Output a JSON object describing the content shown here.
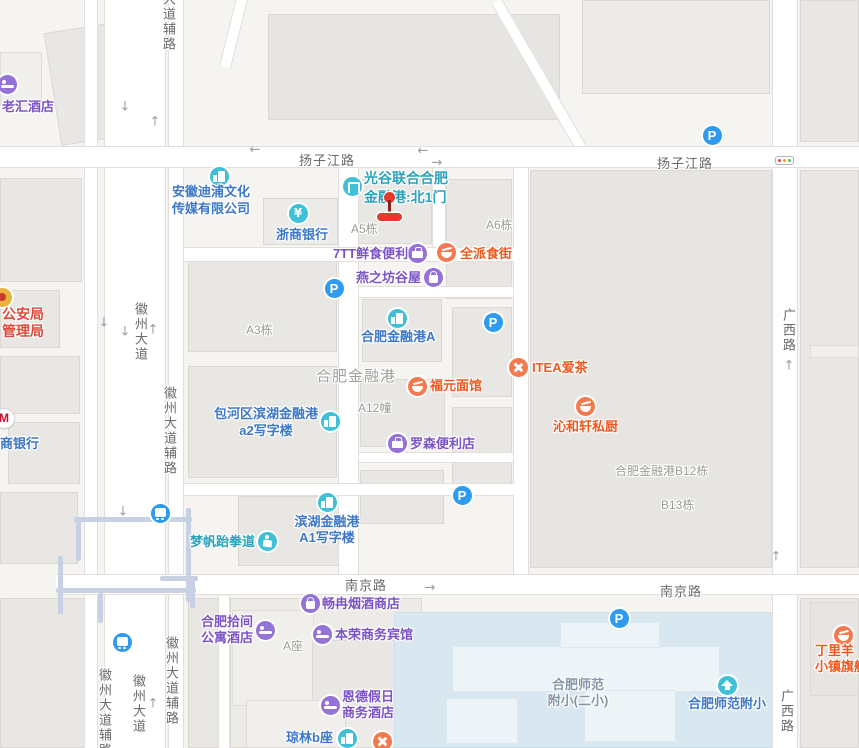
{
  "colors": {
    "purple_icon": "#9472d6",
    "purple_text": "#7b52c8",
    "teal_icon": "#3fc0d6",
    "blue_text": "#3d77c9",
    "teal_text": "#2aa3ba",
    "orange_icon": "#f5794e",
    "orange_text": "#f2571d",
    "parking_icon": "#2e9af0",
    "bus_icon": "#2e9af0",
    "building_text": "#9d9a96",
    "area_text": "#a3a09c",
    "gov_text": "#de4a3d",
    "school_text": "#8596a7",
    "road_text": "#6a6a6a",
    "marker_red": "#e23b2c"
  },
  "road_labels": [
    {
      "text": "扬子江路",
      "x": 299,
      "y": 150,
      "vertical": false
    },
    {
      "text": "扬子江路",
      "x": 657,
      "y": 153,
      "vertical": false
    },
    {
      "text": "南京路",
      "x": 345,
      "y": 575,
      "vertical": false
    },
    {
      "text": "南京路",
      "x": 660,
      "y": 581,
      "vertical": false
    },
    {
      "text": "广西路",
      "x": 779,
      "y": 308,
      "vertical": true
    },
    {
      "text": "广西路",
      "x": 777,
      "y": 689,
      "vertical": true
    },
    {
      "text": "大道辅路",
      "x": 159,
      "y": -8,
      "vertical": true
    },
    {
      "text": "徽州大道",
      "x": 131,
      "y": 302,
      "vertical": true
    },
    {
      "text": "徽州大道辅路",
      "x": 160,
      "y": 386,
      "vertical": true
    },
    {
      "text": "徽州大道辅路",
      "x": 95,
      "y": 668,
      "vertical": true
    },
    {
      "text": "徽州大道",
      "x": 129,
      "y": 674,
      "vertical": true
    },
    {
      "text": "徽州大道辅路",
      "x": 162,
      "y": 636,
      "vertical": true
    }
  ],
  "building_labels": [
    {
      "text": "A5栋",
      "x": 351,
      "y": 220
    },
    {
      "text": "A6栋",
      "x": 486,
      "y": 216
    },
    {
      "text": "A3栋",
      "x": 246,
      "y": 321
    },
    {
      "text": "A12幢",
      "x": 358,
      "y": 399
    },
    {
      "text": "合肥金融港B12栋",
      "x": 615,
      "y": 462
    },
    {
      "text": "B13栋",
      "x": 661,
      "y": 496
    },
    {
      "text": "A座",
      "x": 283,
      "y": 637
    }
  ],
  "area_labels": [
    {
      "text": "合肥金融港",
      "x": 316,
      "y": 365
    }
  ],
  "school_labels": [
    {
      "lines": [
        "合肥师范",
        "附小(二小)"
      ],
      "cx": 578,
      "y": 677
    }
  ],
  "pois": [
    {
      "id": "laohui-hotel",
      "icon": {
        "type": "bed",
        "name": "hotel-icon",
        "color": "purple_icon",
        "x": 7,
        "y": 84
      },
      "label": {
        "lines": [
          "老汇酒店"
        ],
        "color": "purple_text",
        "x": 2,
        "y": 99
      }
    },
    {
      "id": "police-bureau",
      "icon": {
        "type": "emblem",
        "name": "police-emblem-icon",
        "color": "",
        "x": 2,
        "y": 297
      },
      "label": {
        "lines": [
          "公安局",
          "管理局"
        ],
        "color": "gov_text",
        "x": 2,
        "y": 306,
        "size": 14,
        "lh": 17
      }
    },
    {
      "id": "cmb-bank",
      "icon": {
        "type": "M",
        "name": "cmb-logo-icon",
        "color": "",
        "x": 4,
        "y": 418
      },
      "label": {
        "lines": [
          "商银行"
        ],
        "color": "blue_text",
        "x": 0,
        "y": 436
      }
    },
    {
      "id": "anhui-dipu-company",
      "icon": {
        "type": "bldg",
        "name": "company-icon",
        "color": "teal_icon",
        "x": 219,
        "y": 176
      },
      "label": {
        "lines": [
          "安徽迪浦文化",
          "传媒有限公司"
        ],
        "color": "blue_text",
        "x": 172,
        "y": 183,
        "lh": 17
      }
    },
    {
      "id": "zheshang-bank",
      "icon": {
        "type": "yen",
        "name": "bank-yen-icon",
        "color": "teal_icon",
        "x": 298,
        "y": 213
      },
      "label": {
        "lines": [
          "浙商银行"
        ],
        "color": "blue_text",
        "x": 276,
        "y": 227
      }
    },
    {
      "id": "financial-port-north-gate",
      "icon": {
        "type": "gate",
        "name": "gate-icon",
        "color": "teal_icon",
        "x": 352,
        "y": 186
      },
      "label": {
        "lines": [
          "光谷联合合肥",
          "金融港:北1门"
        ],
        "color": "teal_text",
        "x": 364,
        "y": 169,
        "size": 14,
        "lh": 19
      }
    },
    {
      "id": "7tt-convenience",
      "icon": {
        "type": "shop",
        "name": "shop-icon",
        "color": "purple_icon",
        "x": 417,
        "y": 253
      },
      "label": {
        "lines": [
          "7TT鲜食便利"
        ],
        "color": "purple_text",
        "x": 333,
        "y": 246
      }
    },
    {
      "id": "quanpai-food-street",
      "icon": {
        "type": "bowl",
        "name": "restaurant-icon",
        "color": "orange_icon",
        "x": 446,
        "y": 252
      },
      "label": {
        "lines": [
          "全派食街"
        ],
        "color": "orange_text",
        "x": 460,
        "y": 246
      }
    },
    {
      "id": "yanzhifang-guwu",
      "icon": {
        "type": "bag",
        "name": "shopping-bag-icon",
        "color": "purple_icon",
        "x": 433,
        "y": 277
      },
      "label": {
        "lines": [
          "燕之坊谷屋"
        ],
        "color": "purple_text",
        "x": 356,
        "y": 270
      }
    },
    {
      "id": "parking-1",
      "icon": {
        "type": "P",
        "name": "parking-icon",
        "color": "parking_icon",
        "x": 334,
        "y": 288
      }
    },
    {
      "id": "financial-port-a",
      "icon": {
        "type": "bldg",
        "name": "building-icon",
        "color": "teal_icon",
        "x": 397,
        "y": 318
      },
      "label": {
        "lines": [
          "合肥金融港A"
        ],
        "color": "blue_text",
        "x": 361,
        "y": 329
      }
    },
    {
      "id": "parking-2",
      "icon": {
        "type": "P",
        "name": "parking-icon",
        "color": "parking_icon",
        "x": 493,
        "y": 322
      }
    },
    {
      "id": "fuyuan-noodles",
      "icon": {
        "type": "bowl",
        "name": "restaurant-icon",
        "color": "orange_icon",
        "x": 417,
        "y": 386
      },
      "label": {
        "lines": [
          "福元面馆"
        ],
        "color": "orange_text",
        "x": 430,
        "y": 378
      }
    },
    {
      "id": "itea-tea",
      "icon": {
        "type": "utensils",
        "name": "restaurant-icon",
        "color": "orange_icon",
        "x": 518,
        "y": 367
      },
      "label": {
        "lines": [
          "ITEA爱茶"
        ],
        "color": "orange_text",
        "x": 532,
        "y": 360
      }
    },
    {
      "id": "qinhexuan-kitchen",
      "icon": {
        "type": "bowl",
        "name": "restaurant-icon",
        "color": "orange_icon",
        "x": 585,
        "y": 406
      },
      "label": {
        "lines": [
          "沁和轩私厨"
        ],
        "color": "orange_text",
        "x": 553,
        "y": 419
      }
    },
    {
      "id": "baohe-a2-office",
      "icon": {
        "type": "bldg",
        "name": "building-icon",
        "color": "teal_icon",
        "x": 330,
        "y": 421
      },
      "label": {
        "lines": [
          "包河区滨湖金融港",
          "a2写字楼"
        ],
        "color": "blue_text",
        "cx": 266,
        "y": 405,
        "lh": 17
      }
    },
    {
      "id": "lawson-store",
      "icon": {
        "type": "shop",
        "name": "shop-icon",
        "color": "purple_icon",
        "x": 397,
        "y": 443
      },
      "label": {
        "lines": [
          "罗森便利店"
        ],
        "color": "purple_text",
        "x": 410,
        "y": 436
      }
    },
    {
      "id": "bus-station-1",
      "icon": {
        "type": "bus",
        "name": "bus-station-icon",
        "color": "bus_icon",
        "x": 160,
        "y": 513
      }
    },
    {
      "id": "mengfan-taekwondo",
      "icon": {
        "type": "person",
        "name": "person-sport-icon",
        "color": "teal_icon",
        "x": 267,
        "y": 541
      },
      "label": {
        "lines": [
          "梦帆跆拳道"
        ],
        "color": "teal_text",
        "x": 190,
        "y": 534
      }
    },
    {
      "id": "binhu-a1-office",
      "icon": {
        "type": "bldg",
        "name": "building-icon",
        "color": "teal_icon",
        "x": 327,
        "y": 502
      },
      "label": {
        "lines": [
          "滨湖金融港",
          "A1写字楼"
        ],
        "color": "blue_text",
        "cx": 327,
        "y": 514
      }
    },
    {
      "id": "parking-3",
      "icon": {
        "type": "P",
        "name": "parking-icon",
        "color": "parking_icon",
        "x": 462,
        "y": 495
      }
    },
    {
      "id": "changran-tobacco",
      "icon": {
        "type": "bag",
        "name": "shopping-bag-icon",
        "color": "purple_icon",
        "x": 310,
        "y": 603
      },
      "label": {
        "lines": [
          "畅冉烟酒商店"
        ],
        "color": "purple_text",
        "x": 322,
        "y": 596
      }
    },
    {
      "id": "shijian-apartment-hotel",
      "icon": {
        "type": "bed",
        "name": "hotel-icon",
        "color": "purple_icon",
        "x": 265,
        "y": 630
      },
      "label": {
        "lines": [
          "合肥拾间",
          "公寓酒店"
        ],
        "color": "purple_text",
        "x": 201,
        "y": 614
      }
    },
    {
      "id": "benrong-hotel",
      "icon": {
        "type": "bed",
        "name": "hotel-icon",
        "color": "purple_icon",
        "x": 322,
        "y": 634
      },
      "label": {
        "lines": [
          "本荣商务宾馆"
        ],
        "color": "purple_text",
        "x": 335,
        "y": 627
      }
    },
    {
      "id": "parking-4",
      "icon": {
        "type": "P",
        "name": "parking-icon",
        "color": "parking_icon",
        "x": 619,
        "y": 618
      }
    },
    {
      "id": "bus-station-2",
      "icon": {
        "type": "bus",
        "name": "bus-station-icon",
        "color": "bus_icon",
        "x": 122,
        "y": 642
      }
    },
    {
      "id": "ende-holiday-hotel",
      "icon": {
        "type": "bed",
        "name": "hotel-icon",
        "color": "purple_icon",
        "x": 330,
        "y": 705
      },
      "label": {
        "lines": [
          "恩德假日",
          "商务酒店"
        ],
        "color": "purple_text",
        "x": 342,
        "y": 689
      }
    },
    {
      "id": "qionglin-b",
      "icon": {
        "type": "bldg",
        "name": "building-icon",
        "color": "teal_icon",
        "x": 347,
        "y": 738
      },
      "label": {
        "lines": [
          "琼林b座"
        ],
        "color": "blue_text",
        "x": 286,
        "y": 730
      }
    },
    {
      "id": "restaurant-edge",
      "icon": {
        "type": "utensils",
        "name": "restaurant-icon",
        "color": "orange_icon",
        "x": 382,
        "y": 741
      }
    },
    {
      "id": "shifan-primary",
      "icon": {
        "type": "cap",
        "name": "school-icon",
        "color": "teal_icon",
        "x": 727,
        "y": 685
      },
      "label": {
        "lines": [
          "合肥师范附小"
        ],
        "color": "blue_text",
        "x": 688,
        "y": 696
      }
    },
    {
      "id": "dingliyang-flagship",
      "icon": {
        "type": "bowl",
        "name": "restaurant-icon",
        "color": "orange_icon",
        "x": 843,
        "y": 635
      },
      "label": {
        "lines": [
          "丁里羊",
          "小镇旗舰店"
        ],
        "color": "orange_text",
        "x": 815,
        "y": 643
      }
    },
    {
      "id": "parking-5",
      "icon": {
        "type": "P",
        "name": "parking-icon",
        "color": "parking_icon",
        "x": 712,
        "y": 135
      }
    }
  ],
  "marker": {
    "ball_x": 384,
    "ball_y": 192,
    "stem_x": 388,
    "stem_y": 200,
    "stem_h": 15,
    "bar_x": 377,
    "bar_y": 213
  },
  "arrows": [
    {
      "c": "↓",
      "x": 125,
      "y": 107
    },
    {
      "c": "↑",
      "x": 155,
      "y": 122
    },
    {
      "c": "←",
      "x": 255,
      "y": 150
    },
    {
      "c": "←",
      "x": 423,
      "y": 151
    },
    {
      "c": "→",
      "x": 437,
      "y": 163
    },
    {
      "c": "↓",
      "x": 104,
      "y": 323
    },
    {
      "c": "↓",
      "x": 125,
      "y": 332
    },
    {
      "c": "↑",
      "x": 153,
      "y": 330
    },
    {
      "c": "↓",
      "x": 123,
      "y": 512
    },
    {
      "c": "↑",
      "x": 153,
      "y": 704
    },
    {
      "c": "→",
      "x": 430,
      "y": 588
    },
    {
      "c": "↑",
      "x": 789,
      "y": 366
    },
    {
      "c": "↑",
      "x": 776,
      "y": 557
    }
  ],
  "traffic_light": {
    "x": 775,
    "y": 156
  }
}
